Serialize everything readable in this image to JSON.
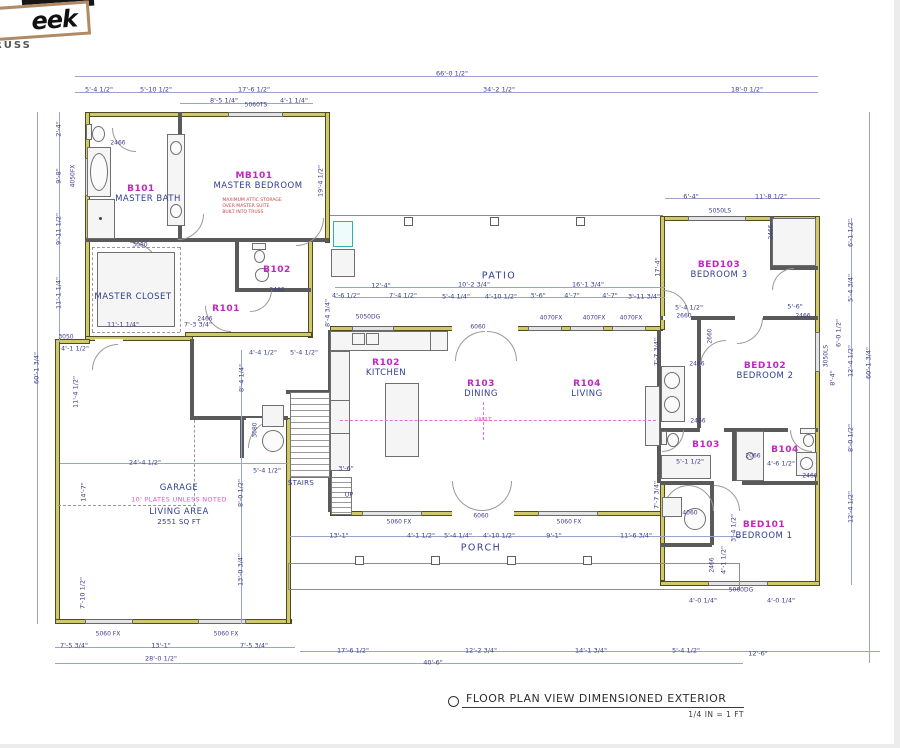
{
  "logo": {
    "word": "eek",
    "sub": "RUSS"
  },
  "title": {
    "text": "FLOOR PLAN VIEW DIMENSIONED EXTERIOR",
    "scale": "1/4 IN = 1 FT"
  },
  "colors": {
    "exterior_wall": "#cfc96b",
    "room_id": "#c126c1",
    "room_name": "#303d8d",
    "dimension": "#3c3c8e",
    "note_pink": "#e956c5",
    "note_red": "#c44545"
  },
  "labels": [
    {
      "t": "B101",
      "x": 141,
      "y": 189,
      "c": "id"
    },
    {
      "t": "MASTER BATH",
      "x": 148,
      "y": 200,
      "c": "name"
    },
    {
      "t": "MB101",
      "x": 254,
      "y": 176,
      "c": "id"
    },
    {
      "t": "MASTER BEDROOM",
      "x": 258,
      "y": 187,
      "c": "name"
    },
    {
      "t": "MAXIMUM ATTIC STORAGE\nOVER MASTER SUITE\nBUILT INTO TRUSS",
      "x": 252,
      "y": 207,
      "c": "red"
    },
    {
      "t": "MASTER CLOSET",
      "x": 133,
      "y": 298,
      "c": "name"
    },
    {
      "t": "R101",
      "x": 226,
      "y": 309,
      "c": "id"
    },
    {
      "t": "B102",
      "x": 277,
      "y": 270,
      "c": "id"
    },
    {
      "t": "R102",
      "x": 386,
      "y": 363,
      "c": "id"
    },
    {
      "t": "KITCHEN",
      "x": 386,
      "y": 374,
      "c": "name"
    },
    {
      "t": "R103",
      "x": 481,
      "y": 384,
      "c": "id"
    },
    {
      "t": "DINING",
      "x": 481,
      "y": 395,
      "c": "name"
    },
    {
      "t": "R104",
      "x": 587,
      "y": 384,
      "c": "id"
    },
    {
      "t": "LIVING",
      "x": 587,
      "y": 395,
      "c": "name"
    },
    {
      "t": "VAULT",
      "x": 483,
      "y": 420,
      "c": "pinkS"
    },
    {
      "t": "BED103",
      "x": 719,
      "y": 265,
      "c": "id"
    },
    {
      "t": "BEDROOM 3",
      "x": 719,
      "y": 276,
      "c": "name"
    },
    {
      "t": "BED102",
      "x": 765,
      "y": 366,
      "c": "id"
    },
    {
      "t": "BEDROOM 2",
      "x": 765,
      "y": 377,
      "c": "name"
    },
    {
      "t": "B103",
      "x": 706,
      "y": 445,
      "c": "id"
    },
    {
      "t": "B104",
      "x": 785,
      "y": 450,
      "c": "id"
    },
    {
      "t": "BED101",
      "x": 764,
      "y": 525,
      "c": "id"
    },
    {
      "t": "BEDROOM 1",
      "x": 764,
      "y": 537,
      "c": "name"
    },
    {
      "t": "GARAGE",
      "x": 179,
      "y": 489,
      "c": "name"
    },
    {
      "t": "10' PLATES UNLESS NOTED",
      "x": 179,
      "y": 500,
      "c": "pink"
    },
    {
      "t": "LIVING AREA",
      "x": 179,
      "y": 513,
      "c": "name"
    },
    {
      "t": "2551 SQ FT",
      "x": 179,
      "y": 522,
      "c": "nmS"
    },
    {
      "t": "PATIO",
      "x": 499,
      "y": 277,
      "c": "area"
    },
    {
      "t": "PORCH",
      "x": 481,
      "y": 549,
      "c": "area"
    },
    {
      "t": "STAIRS",
      "x": 301,
      "y": 483,
      "c": "nmS"
    },
    {
      "t": "UP",
      "x": 349,
      "y": 495,
      "c": "dim"
    },
    {
      "t": "66'-0 1/2\"",
      "x": 452,
      "y": 74,
      "c": "dim"
    },
    {
      "t": "5'-4 1/2\"",
      "x": 99,
      "y": 90,
      "c": "dim"
    },
    {
      "t": "5'-10 1/2\"",
      "x": 156,
      "y": 90,
      "c": "dim"
    },
    {
      "t": "17'-6 1/2\"",
      "x": 254,
      "y": 90,
      "c": "dim"
    },
    {
      "t": "34'-2 1/2\"",
      "x": 499,
      "y": 90,
      "c": "dim"
    },
    {
      "t": "18'-0 1/2\"",
      "x": 747,
      "y": 90,
      "c": "dim"
    },
    {
      "t": "8'-5 1/4\"",
      "x": 224,
      "y": 101,
      "c": "dim"
    },
    {
      "t": "4'-1 1/4\"",
      "x": 294,
      "y": 101,
      "c": "dim"
    },
    {
      "t": "5060TS",
      "x": 256,
      "y": 106,
      "c": "win"
    },
    {
      "t": "6'-4\"",
      "x": 691,
      "y": 197,
      "c": "dim"
    },
    {
      "t": "11'-8 1/2\"",
      "x": 771,
      "y": 197,
      "c": "dim"
    },
    {
      "t": "5050LS",
      "x": 720,
      "y": 212,
      "c": "win"
    },
    {
      "t": "60'-1 3/4\"",
      "x": 37,
      "y": 368,
      "c": "dim",
      "r": 1
    },
    {
      "t": "2'-4\"",
      "x": 59,
      "y": 129,
      "c": "dim",
      "r": 1
    },
    {
      "t": "9'-8\"",
      "x": 59,
      "y": 176,
      "c": "dim",
      "r": 1
    },
    {
      "t": "4050FX",
      "x": 74,
      "y": 176,
      "c": "win",
      "r": 1
    },
    {
      "t": "9'-11 1/2\"",
      "x": 59,
      "y": 229,
      "c": "dim",
      "r": 1
    },
    {
      "t": "11'-1 1/4\"",
      "x": 59,
      "y": 293,
      "c": "dim",
      "r": 1
    },
    {
      "t": "3050",
      "x": 66,
      "y": 338,
      "c": "win"
    },
    {
      "t": "4'-1 1/2\"",
      "x": 75,
      "y": 349,
      "c": "dim"
    },
    {
      "t": "11'-4 1/2\"",
      "x": 76,
      "y": 392,
      "c": "dim",
      "r": 1
    },
    {
      "t": "14'-7\"",
      "x": 84,
      "y": 492,
      "c": "dim",
      "r": 1
    },
    {
      "t": "7'-10 1/2\"",
      "x": 83,
      "y": 593,
      "c": "dim",
      "r": 1
    },
    {
      "t": "2466",
      "x": 118,
      "y": 144,
      "c": "win"
    },
    {
      "t": "3080",
      "x": 140,
      "y": 246,
      "c": "win"
    },
    {
      "t": "2460",
      "x": 277,
      "y": 291,
      "c": "win"
    },
    {
      "t": "2466",
      "x": 205,
      "y": 320,
      "c": "win"
    },
    {
      "t": "11'-1 1/4\"",
      "x": 123,
      "y": 325,
      "c": "dim"
    },
    {
      "t": "7'-3 3/4\"",
      "x": 198,
      "y": 325,
      "c": "dim"
    },
    {
      "t": "19'-4 1/2\"",
      "x": 321,
      "y": 181,
      "c": "dim",
      "r": 1
    },
    {
      "t": "8'-4 3/4\"",
      "x": 328,
      "y": 313,
      "c": "dim",
      "r": 1
    },
    {
      "t": "4'-4 1/2\"",
      "x": 263,
      "y": 353,
      "c": "dim"
    },
    {
      "t": "5'-4 1/2\"",
      "x": 304,
      "y": 353,
      "c": "dim"
    },
    {
      "t": "8'-4 1/4\"",
      "x": 242,
      "y": 378,
      "c": "dim",
      "r": 1
    },
    {
      "t": "3080",
      "x": 256,
      "y": 430,
      "c": "win",
      "r": 1
    },
    {
      "t": "24'-4 1/2\"",
      "x": 145,
      "y": 463,
      "c": "dim"
    },
    {
      "t": "5'-4 1/2\"",
      "x": 267,
      "y": 471,
      "c": "dim"
    },
    {
      "t": "8'-0 1/2\"",
      "x": 241,
      "y": 493,
      "c": "dim",
      "r": 1
    },
    {
      "t": "13'-0 3/4\"",
      "x": 241,
      "y": 570,
      "c": "dim",
      "r": 1
    },
    {
      "t": "3'-6\"",
      "x": 346,
      "y": 469,
      "c": "dim"
    },
    {
      "t": "12'-4\"",
      "x": 381,
      "y": 286,
      "c": "dim"
    },
    {
      "t": "10'-2 3/4\"",
      "x": 474,
      "y": 285,
      "c": "dim"
    },
    {
      "t": "16'-1 3/4\"",
      "x": 588,
      "y": 285,
      "c": "dim"
    },
    {
      "t": "4'-6 1/2\"",
      "x": 346,
      "y": 296,
      "c": "dim"
    },
    {
      "t": "7'-4 1/2\"",
      "x": 403,
      "y": 296,
      "c": "dim"
    },
    {
      "t": "5'-4 1/4\"",
      "x": 456,
      "y": 297,
      "c": "dim"
    },
    {
      "t": "4'-10 1/2\"",
      "x": 501,
      "y": 297,
      "c": "dim"
    },
    {
      "t": "3'-6\"",
      "x": 538,
      "y": 296,
      "c": "dim"
    },
    {
      "t": "4'-7\"",
      "x": 572,
      "y": 296,
      "c": "dim"
    },
    {
      "t": "4'-7\"",
      "x": 610,
      "y": 296,
      "c": "dim"
    },
    {
      "t": "3'-11 3/4\"",
      "x": 644,
      "y": 297,
      "c": "dim"
    },
    {
      "t": "5050DG",
      "x": 368,
      "y": 318,
      "c": "win"
    },
    {
      "t": "4070FX",
      "x": 551,
      "y": 319,
      "c": "win"
    },
    {
      "t": "4070FX",
      "x": 594,
      "y": 319,
      "c": "win"
    },
    {
      "t": "4070FX",
      "x": 631,
      "y": 319,
      "c": "win"
    },
    {
      "t": "6060",
      "x": 478,
      "y": 328,
      "c": "win"
    },
    {
      "t": "17'-4\"",
      "x": 658,
      "y": 267,
      "c": "dim",
      "r": 1
    },
    {
      "t": "13'-1\"",
      "x": 339,
      "y": 536,
      "c": "dim"
    },
    {
      "t": "4'-1 1/2\"",
      "x": 421,
      "y": 536,
      "c": "dim"
    },
    {
      "t": "5'-4 1/4\"",
      "x": 458,
      "y": 536,
      "c": "dim"
    },
    {
      "t": "4'-10 1/2\"",
      "x": 499,
      "y": 536,
      "c": "dim"
    },
    {
      "t": "9'-1\"",
      "x": 554,
      "y": 536,
      "c": "dim"
    },
    {
      "t": "11'-6 3/4\"",
      "x": 636,
      "y": 536,
      "c": "dim"
    },
    {
      "t": "5060 FX",
      "x": 399,
      "y": 523,
      "c": "win"
    },
    {
      "t": "5060 FX",
      "x": 569,
      "y": 523,
      "c": "win"
    },
    {
      "t": "6060",
      "x": 481,
      "y": 517,
      "c": "win"
    },
    {
      "t": "5060 FX",
      "x": 108,
      "y": 635,
      "c": "win"
    },
    {
      "t": "5060 FX",
      "x": 226,
      "y": 635,
      "c": "win"
    },
    {
      "t": "7'-5 3/4\"",
      "x": 74,
      "y": 646,
      "c": "dim"
    },
    {
      "t": "13'-1\"",
      "x": 161,
      "y": 646,
      "c": "dim"
    },
    {
      "t": "7'-5 3/4\"",
      "x": 254,
      "y": 646,
      "c": "dim"
    },
    {
      "t": "28'-0 1/2\"",
      "x": 161,
      "y": 659,
      "c": "dim"
    },
    {
      "t": "17'-6 1/2\"",
      "x": 353,
      "y": 651,
      "c": "dim"
    },
    {
      "t": "12'-2 3/4\"",
      "x": 481,
      "y": 651,
      "c": "dim"
    },
    {
      "t": "14'-1 3/4\"",
      "x": 591,
      "y": 651,
      "c": "dim"
    },
    {
      "t": "5'-4 1/2\"",
      "x": 686,
      "y": 651,
      "c": "dim"
    },
    {
      "t": "12'-6\"",
      "x": 758,
      "y": 654,
      "c": "dim"
    },
    {
      "t": "40'-6\"",
      "x": 433,
      "y": 663,
      "c": "dim"
    },
    {
      "t": "4'-0 1/4\"",
      "x": 703,
      "y": 601,
      "c": "dim"
    },
    {
      "t": "4'-0 1/4\"",
      "x": 781,
      "y": 601,
      "c": "dim"
    },
    {
      "t": "5060DG",
      "x": 741,
      "y": 591,
      "c": "win"
    },
    {
      "t": "6'-1 1/2\"",
      "x": 851,
      "y": 233,
      "c": "dim",
      "r": 1
    },
    {
      "t": "5'-4 3/4\"",
      "x": 851,
      "y": 288,
      "c": "dim",
      "r": 1
    },
    {
      "t": "6'-0 1/2\"",
      "x": 839,
      "y": 333,
      "c": "dim",
      "r": 1
    },
    {
      "t": "12'-4 1/2\"",
      "x": 851,
      "y": 361,
      "c": "dim",
      "r": 1
    },
    {
      "t": "8'-4\"",
      "x": 833,
      "y": 378,
      "c": "dim",
      "r": 1
    },
    {
      "t": "60'-1 3/4\"",
      "x": 869,
      "y": 363,
      "c": "dim",
      "r": 1
    },
    {
      "t": "8'-0 1/2\"",
      "x": 851,
      "y": 438,
      "c": "dim",
      "r": 1
    },
    {
      "t": "12'-4 1/2\"",
      "x": 851,
      "y": 507,
      "c": "dim",
      "r": 1
    },
    {
      "t": "3050LS",
      "x": 827,
      "y": 356,
      "c": "win",
      "r": 1
    },
    {
      "t": "7'-7 3/4\"",
      "x": 657,
      "y": 352,
      "c": "dim",
      "r": 1
    },
    {
      "t": "7'-7 3/4\"",
      "x": 657,
      "y": 495,
      "c": "dim",
      "r": 1
    },
    {
      "t": "5'-4 1/2\"",
      "x": 689,
      "y": 308,
      "c": "dim"
    },
    {
      "t": "5'-6\"",
      "x": 795,
      "y": 307,
      "c": "dim"
    },
    {
      "t": "2660",
      "x": 684,
      "y": 317,
      "c": "win"
    },
    {
      "t": "2466",
      "x": 803,
      "y": 317,
      "c": "win"
    },
    {
      "t": "2466",
      "x": 772,
      "y": 232,
      "c": "win",
      "r": 1
    },
    {
      "t": "2660",
      "x": 711,
      "y": 336,
      "c": "win",
      "r": 1
    },
    {
      "t": "2466",
      "x": 697,
      "y": 365,
      "c": "win"
    },
    {
      "t": "2466",
      "x": 698,
      "y": 422,
      "c": "win"
    },
    {
      "t": "5'-1 1/2\"",
      "x": 690,
      "y": 462,
      "c": "dim"
    },
    {
      "t": "4'-6 1/2\"",
      "x": 781,
      "y": 464,
      "c": "dim"
    },
    {
      "t": "2066",
      "x": 753,
      "y": 457,
      "c": "win"
    },
    {
      "t": "2466",
      "x": 810,
      "y": 477,
      "c": "win"
    },
    {
      "t": "4060",
      "x": 690,
      "y": 514,
      "c": "win"
    },
    {
      "t": "3'-4 1/2\"",
      "x": 734,
      "y": 528,
      "c": "dim",
      "r": 1
    },
    {
      "t": "4'-1 1/2\"",
      "x": 724,
      "y": 560,
      "c": "dim",
      "r": 1
    },
    {
      "t": "2466",
      "x": 713,
      "y": 565,
      "c": "win",
      "r": 1
    }
  ]
}
